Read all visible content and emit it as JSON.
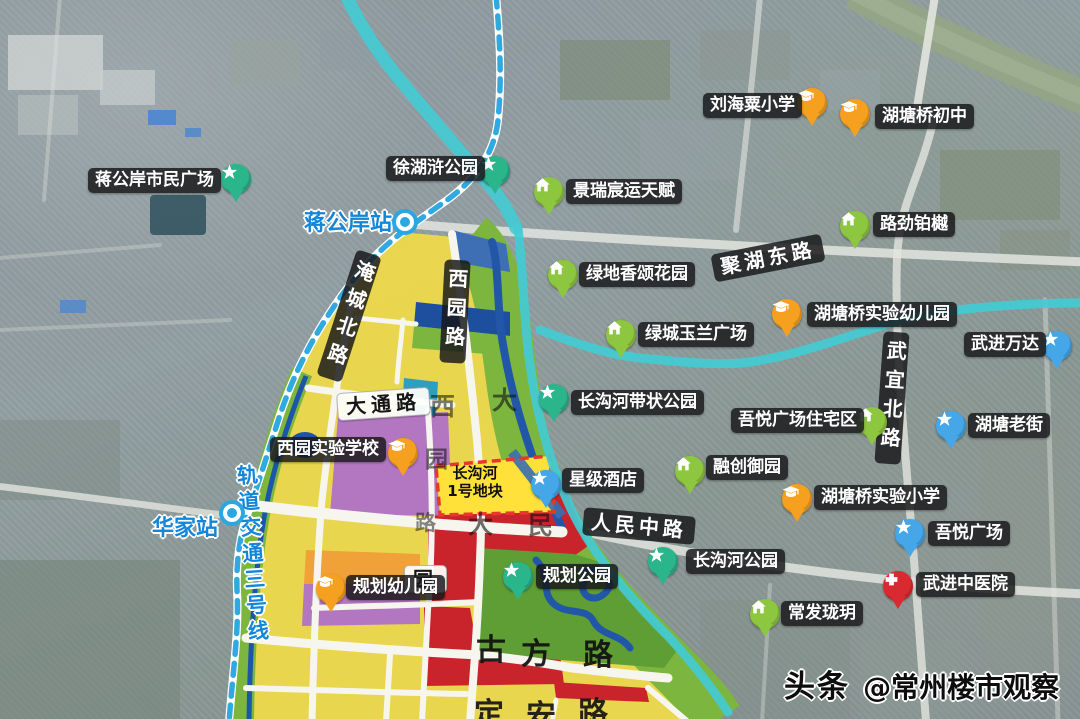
{
  "watermark": {
    "brand": "头条",
    "handle": "@常州楼市观察"
  },
  "parcel": {
    "name_line1": "长沟河",
    "name_line2": "1号地块"
  },
  "stations": [
    {
      "name": "蒋公岸站",
      "label_x": 304,
      "label_y": 213,
      "label_size": 22,
      "dot_x": 396,
      "dot_y": 213
    },
    {
      "name": "华家站",
      "label_x": 152,
      "label_y": 518,
      "label_size": 22,
      "dot_x": 223,
      "dot_y": 504
    }
  ],
  "metro_line_label": {
    "text": "轨道交通三号线",
    "x": 241,
    "y": 464,
    "size": 21,
    "rotate": -4
  },
  "road_badges": [
    {
      "text": "聚湖东路",
      "x": 712,
      "y": 244,
      "vertical": false,
      "style": "dark",
      "rotate": -11
    },
    {
      "text": "武宜北路",
      "x": 879,
      "y": 332,
      "vertical": true,
      "style": "dark",
      "rotate": 4
    },
    {
      "text": "人民中路",
      "x": 583,
      "y": 512,
      "vertical": false,
      "style": "dark",
      "rotate": 5
    },
    {
      "text": "淹城北路",
      "x": 336,
      "y": 250,
      "vertical": true,
      "style": "dark",
      "rotate": 18
    },
    {
      "text": "西园路",
      "x": 442,
      "y": 260,
      "vertical": true,
      "style": "dark",
      "rotate": 3
    },
    {
      "text": "大通路",
      "x": 337,
      "y": 390,
      "vertical": false,
      "style": "light",
      "rotate": -4
    },
    {
      "text": "园",
      "x": 404,
      "y": 565,
      "vertical": false,
      "style": "light",
      "rotate": 0
    }
  ],
  "street_labels": [
    {
      "char": "古",
      "x": 476,
      "y": 636,
      "size": 30,
      "opacity": 0.92
    },
    {
      "char": "方",
      "x": 521,
      "y": 640,
      "size": 30,
      "opacity": 0.92
    },
    {
      "char": "路",
      "x": 583,
      "y": 641,
      "size": 30,
      "opacity": 0.92
    },
    {
      "char": "定",
      "x": 474,
      "y": 700,
      "size": 30,
      "opacity": 0.9
    },
    {
      "char": "安",
      "x": 526,
      "y": 702,
      "size": 30,
      "opacity": 0.9
    },
    {
      "char": "路",
      "x": 578,
      "y": 699,
      "size": 30,
      "opacity": 0.9
    },
    {
      "char": "西",
      "x": 430,
      "y": 394,
      "size": 25,
      "opacity": 0.55
    },
    {
      "char": "大",
      "x": 492,
      "y": 388,
      "size": 25,
      "opacity": 0.6
    },
    {
      "char": "园",
      "x": 425,
      "y": 449,
      "size": 23,
      "opacity": 0.55
    },
    {
      "char": "路",
      "x": 415,
      "y": 513,
      "size": 21,
      "opacity": 0.5
    },
    {
      "char": "大",
      "x": 468,
      "y": 512,
      "size": 25,
      "opacity": 0.6
    },
    {
      "char": "民",
      "x": 528,
      "y": 513,
      "size": 25,
      "opacity": 0.6
    }
  ],
  "poi_types": {
    "school": {
      "color": "#f5a01f",
      "icon": "graduation-cap"
    },
    "home": {
      "color": "#8dc63f",
      "icon": "house"
    },
    "park": {
      "color": "#2ab58a",
      "icon": "star"
    },
    "mall": {
      "color": "#45a6e8",
      "icon": "star"
    },
    "hospital": {
      "color": "#da2a31",
      "icon": "cross"
    }
  },
  "pois": [
    {
      "label": "刘海粟小学",
      "type": "school",
      "badge": {
        "x": 703,
        "y": 93
      },
      "marker": {
        "x": 797,
        "y": 88
      }
    },
    {
      "label": "湖塘桥初中",
      "type": "school",
      "badge": {
        "x": 875,
        "y": 104
      },
      "marker": {
        "x": 840,
        "y": 99
      }
    },
    {
      "label": "徐湖浒公园",
      "type": "park",
      "badge": {
        "x": 386,
        "y": 156
      },
      "marker": {
        "x": 480,
        "y": 156
      }
    },
    {
      "label": "蒋公岸市民广场",
      "type": "park",
      "badge": {
        "x": 88,
        "y": 168
      },
      "marker": {
        "x": 221,
        "y": 164
      }
    },
    {
      "label": "景瑞宸运天赋",
      "type": "home",
      "badge": {
        "x": 566,
        "y": 179
      },
      "marker": {
        "x": 534,
        "y": 177
      }
    },
    {
      "label": "路劲铂樾",
      "type": "home",
      "badge": {
        "x": 873,
        "y": 212
      },
      "marker": {
        "x": 840,
        "y": 211
      }
    },
    {
      "label": "绿地香颂花园",
      "type": "home",
      "badge": {
        "x": 579,
        "y": 262
      },
      "marker": {
        "x": 548,
        "y": 260
      }
    },
    {
      "label": "湖塘桥实验幼儿园",
      "type": "school",
      "badge": {
        "x": 807,
        "y": 302
      },
      "marker": {
        "x": 772,
        "y": 299
      }
    },
    {
      "label": "武进万达",
      "type": "mall",
      "badge": {
        "x": 964,
        "y": 332
      },
      "marker": {
        "x": 1042,
        "y": 331
      }
    },
    {
      "label": "绿城玉兰广场",
      "type": "home",
      "badge": {
        "x": 638,
        "y": 322
      },
      "marker": {
        "x": 606,
        "y": 320
      }
    },
    {
      "label": "湖塘老街",
      "type": "mall",
      "badge": {
        "x": 968,
        "y": 413
      },
      "marker": {
        "x": 936,
        "y": 411
      }
    },
    {
      "label": "吾悦广场住宅区",
      "type": "home",
      "badge": {
        "x": 731,
        "y": 408
      },
      "marker": {
        "x": 857,
        "y": 407
      }
    },
    {
      "label": "长沟河带状公园",
      "type": "park",
      "badge": {
        "x": 571,
        "y": 390
      },
      "marker": {
        "x": 539,
        "y": 384
      }
    },
    {
      "label": "融创御园",
      "type": "home",
      "badge": {
        "x": 706,
        "y": 455
      },
      "marker": {
        "x": 675,
        "y": 456
      }
    },
    {
      "label": "西园实验学校",
      "type": "school",
      "badge": {
        "x": 270,
        "y": 437
      },
      "marker": {
        "x": 388,
        "y": 438
      }
    },
    {
      "label": "星级酒店",
      "type": "mall",
      "badge": {
        "x": 562,
        "y": 468
      },
      "marker": {
        "x": 531,
        "y": 470
      }
    },
    {
      "label": "湖塘桥实验小学",
      "type": "school",
      "badge": {
        "x": 814,
        "y": 485
      },
      "marker": {
        "x": 782,
        "y": 484
      }
    },
    {
      "label": "吾悦广场",
      "type": "mall",
      "badge": {
        "x": 928,
        "y": 521
      },
      "marker": {
        "x": 895,
        "y": 519
      }
    },
    {
      "label": "长沟河公园",
      "type": "park",
      "badge": {
        "x": 686,
        "y": 549
      },
      "marker": {
        "x": 648,
        "y": 547
      }
    },
    {
      "label": "武进中医院",
      "type": "hospital",
      "badge": {
        "x": 916,
        "y": 572
      },
      "marker": {
        "x": 883,
        "y": 571
      }
    },
    {
      "label": "常发珑玥",
      "type": "home",
      "badge": {
        "x": 781,
        "y": 601
      },
      "marker": {
        "x": 750,
        "y": 599
      }
    },
    {
      "label": "规划幼儿园",
      "type": "school",
      "badge": {
        "x": 346,
        "y": 575
      },
      "marker": {
        "x": 316,
        "y": 574
      }
    },
    {
      "label": "规划公园",
      "type": "park",
      "badge": {
        "x": 536,
        "y": 564
      },
      "marker": {
        "x": 503,
        "y": 562
      }
    }
  ]
}
